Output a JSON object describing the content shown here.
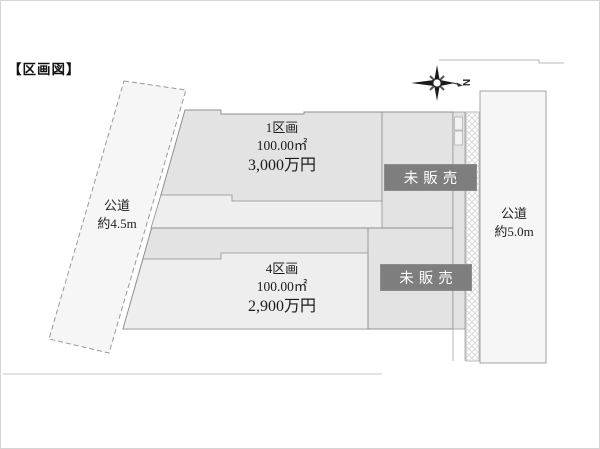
{
  "title": "【区画図】",
  "compass": {
    "north_label": "N"
  },
  "left_road": {
    "name": "公道",
    "width": "約4.5m"
  },
  "right_road": {
    "name": "公道",
    "width": "約5.0m"
  },
  "plots": [
    {
      "id": "plot-1",
      "name": "1区画",
      "area": "100.00㎡",
      "price": "3,000万円"
    },
    {
      "id": "plot-4",
      "name": "4区画",
      "area": "100.00㎡",
      "price": "2,900万円"
    }
  ],
  "unsold_badges": [
    {
      "label": "未販売"
    },
    {
      "label": "未販売"
    }
  ],
  "colors": {
    "plot_fill": "#e3e3e3",
    "plot_inner_fill": "#eeeeee",
    "road_fill": "#f6f6f6",
    "outline": "#8f8f8f",
    "badge_bg": "#7e7e7e",
    "badge_text": "#ffffff",
    "hatch": "#d9d9d9"
  }
}
